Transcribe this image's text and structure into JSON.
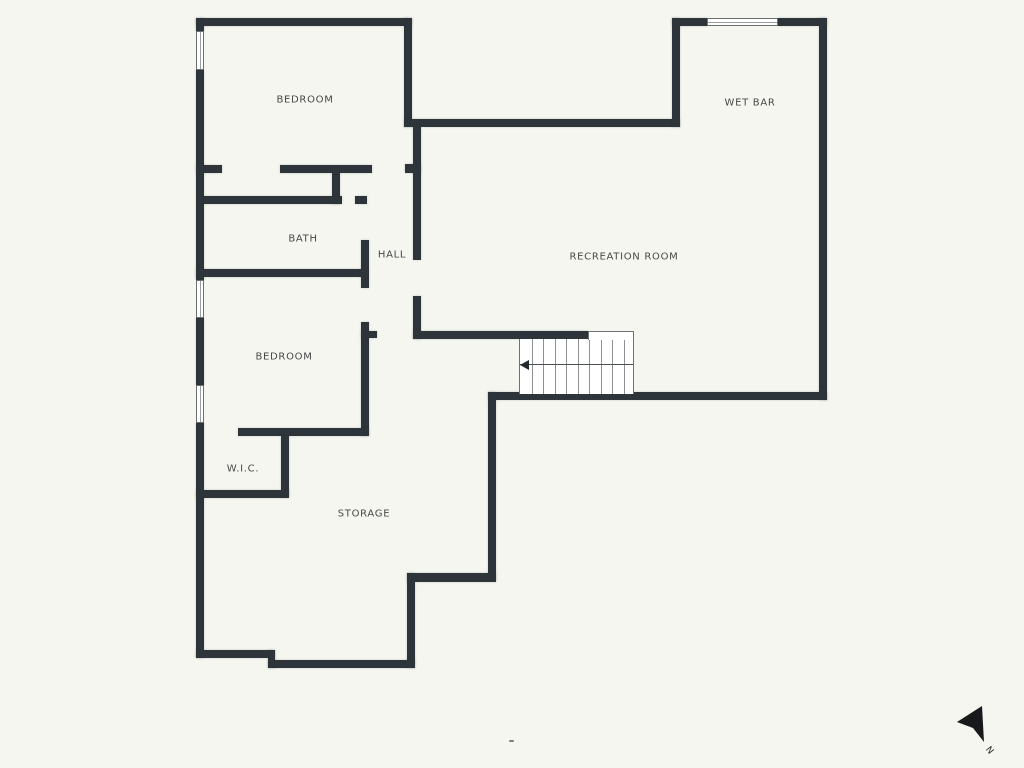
{
  "colors": {
    "background": "#f6f6f1",
    "wall": "#2e353a",
    "thin_line": "#6d7275",
    "text": "#474747"
  },
  "rooms": [
    {
      "id": "bedroom-1",
      "label": "BEDROOM",
      "cx": 305,
      "cy": 100
    },
    {
      "id": "wet-bar",
      "label": "WET BAR",
      "cx": 750,
      "cy": 103
    },
    {
      "id": "bath",
      "label": "BATH",
      "cx": 303,
      "cy": 239
    },
    {
      "id": "hall",
      "label": "HALL",
      "cx": 392,
      "cy": 255
    },
    {
      "id": "recreation-room",
      "label": "RECREATION ROOM",
      "cx": 624,
      "cy": 257
    },
    {
      "id": "bedroom-2",
      "label": "BEDROOM",
      "cx": 284,
      "cy": 357
    },
    {
      "id": "wic",
      "label": "W.I.C.",
      "cx": 243,
      "cy": 469
    },
    {
      "id": "storage",
      "label": "STORAGE",
      "cx": 364,
      "cy": 514
    }
  ],
  "walls": [
    {
      "x": 196,
      "y": 18,
      "w": 216,
      "h": 8
    },
    {
      "x": 196,
      "y": 18,
      "w": 8,
      "h": 14
    },
    {
      "x": 196,
      "y": 70,
      "w": 8,
      "h": 210
    },
    {
      "x": 196,
      "y": 318,
      "w": 8,
      "h": 67
    },
    {
      "x": 196,
      "y": 423,
      "w": 8,
      "h": 235
    },
    {
      "x": 404,
      "y": 18,
      "w": 8,
      "h": 109
    },
    {
      "x": 404,
      "y": 119,
      "w": 276,
      "h": 8
    },
    {
      "x": 672,
      "y": 18,
      "w": 8,
      "h": 109
    },
    {
      "x": 672,
      "y": 18,
      "w": 36,
      "h": 8
    },
    {
      "x": 778,
      "y": 18,
      "w": 49,
      "h": 8
    },
    {
      "x": 819,
      "y": 18,
      "w": 8,
      "h": 382
    },
    {
      "x": 488,
      "y": 392,
      "w": 339,
      "h": 8
    },
    {
      "x": 488,
      "y": 392,
      "w": 8,
      "h": 188
    },
    {
      "x": 407,
      "y": 573,
      "w": 89,
      "h": 9
    },
    {
      "x": 407,
      "y": 573,
      "w": 8,
      "h": 95
    },
    {
      "x": 268,
      "y": 660,
      "w": 147,
      "h": 8
    },
    {
      "x": 268,
      "y": 650,
      "w": 7,
      "h": 18
    },
    {
      "x": 196,
      "y": 650,
      "w": 79,
      "h": 8
    },
    {
      "x": 196,
      "y": 165,
      "w": 26,
      "h": 8
    },
    {
      "x": 280,
      "y": 165,
      "w": 92,
      "h": 8
    },
    {
      "x": 405,
      "y": 164,
      "w": 16,
      "h": 9
    },
    {
      "x": 332,
      "y": 172,
      "w": 8,
      "h": 32
    },
    {
      "x": 204,
      "y": 196,
      "w": 138,
      "h": 8
    },
    {
      "x": 355,
      "y": 196,
      "w": 12,
      "h": 8
    },
    {
      "x": 361,
      "y": 240,
      "w": 8,
      "h": 48
    },
    {
      "x": 196,
      "y": 269,
      "w": 172,
      "h": 8
    },
    {
      "x": 361,
      "y": 322,
      "w": 8,
      "h": 114
    },
    {
      "x": 413,
      "y": 127,
      "w": 8,
      "h": 133
    },
    {
      "x": 413,
      "y": 296,
      "w": 8,
      "h": 43
    },
    {
      "x": 413,
      "y": 331,
      "w": 175,
      "h": 8
    },
    {
      "x": 361,
      "y": 331,
      "w": 16,
      "h": 7
    },
    {
      "x": 238,
      "y": 428,
      "w": 131,
      "h": 8
    },
    {
      "x": 281,
      "y": 436,
      "w": 8,
      "h": 61
    },
    {
      "x": 196,
      "y": 490,
      "w": 93,
      "h": 8
    }
  ],
  "windows": [
    {
      "x": 196,
      "y": 31,
      "w": 8,
      "h": 39,
      "orientation": "v"
    },
    {
      "x": 196,
      "y": 280,
      "w": 8,
      "h": 38,
      "orientation": "v"
    },
    {
      "x": 196,
      "y": 385,
      "w": 8,
      "h": 38,
      "orientation": "v"
    },
    {
      "x": 707,
      "y": 18,
      "w": 71,
      "h": 8,
      "orientation": "h"
    }
  ],
  "stairs": {
    "x": 519,
    "y": 339,
    "w": 115,
    "h": 55,
    "treads": 10,
    "upper_edge": {
      "x": 588,
      "y": 331,
      "w": 46,
      "h": 9
    },
    "direction_line_y": 364,
    "arrow_direction": "left"
  },
  "compass": {
    "label": "N"
  },
  "artifact": {
    "x": 509,
    "y": 740,
    "w": 5,
    "h": 2
  }
}
